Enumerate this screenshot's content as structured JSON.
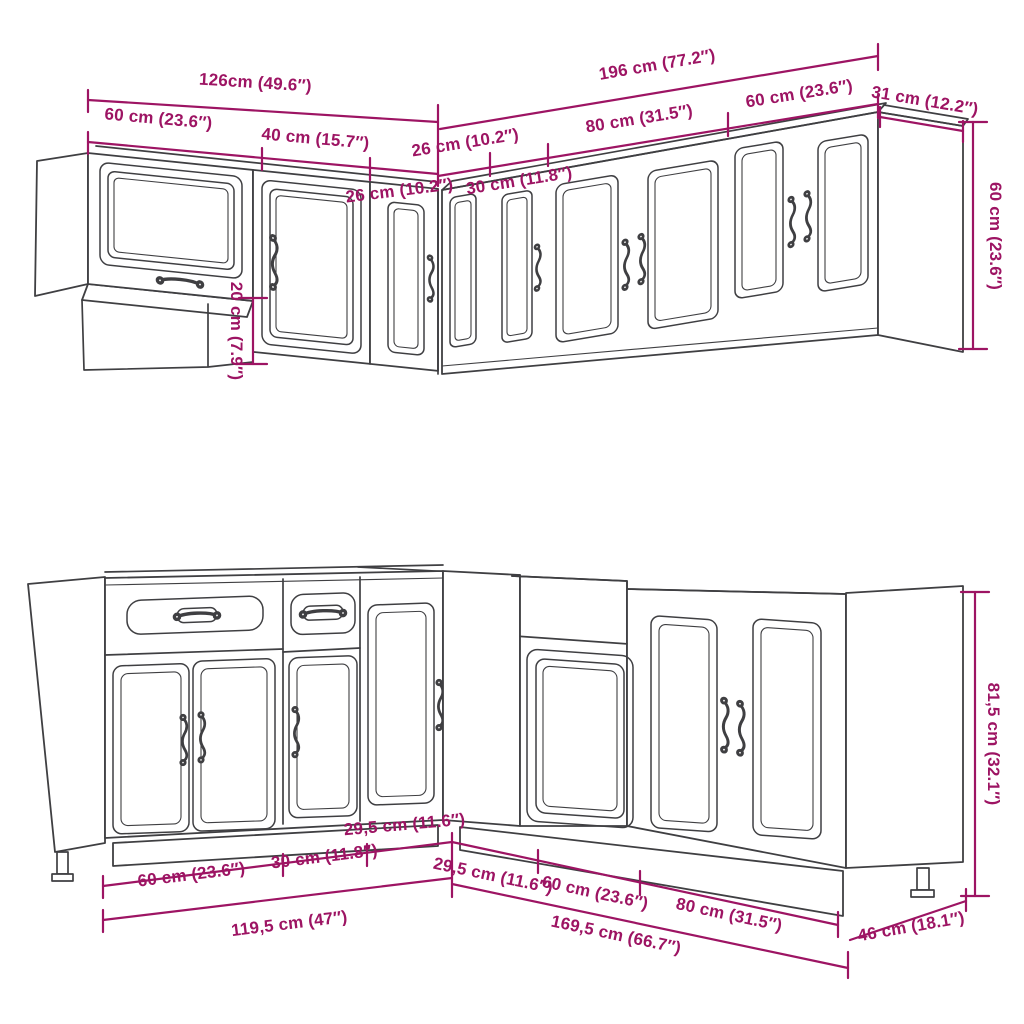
{
  "diagram": {
    "title": "kitchen-cabinet-set-dimension-drawing",
    "colors": {
      "dimension": "#9d1463",
      "line_art": "#3f3f42",
      "background": "#ffffff"
    },
    "wall": {
      "overall_left": "126cm (49.6″)",
      "overall_right": "196 cm (77.2″)",
      "segments_left": [
        "60 cm (23.6″)",
        "40 cm (15.7″)",
        "26 cm (10.2″)"
      ],
      "segments_right": [
        "26 cm (10.2″)",
        "30 cm (11.8″)",
        "80 cm (31.5″)",
        "60 cm (23.6″)"
      ],
      "side_depth": "31 cm (12.2″)",
      "height": "60 cm (23.6″)",
      "offset_height": "20 cm (7.9″)"
    },
    "base": {
      "overall_left": "119,5 cm (47″)",
      "overall_right": "169,5 cm (66.7″)",
      "segments_left": [
        "60 cm (23.6″)",
        "30 cm (11.8″)",
        "29,5 cm (11.6″)"
      ],
      "segments_right": [
        "29,5 cm (11.6″)",
        "60 cm (23.6″)",
        "80 cm (31.5″)"
      ],
      "side_depth": "46 cm (18.1″)",
      "height": "81,5 cm (32.1″)"
    }
  }
}
